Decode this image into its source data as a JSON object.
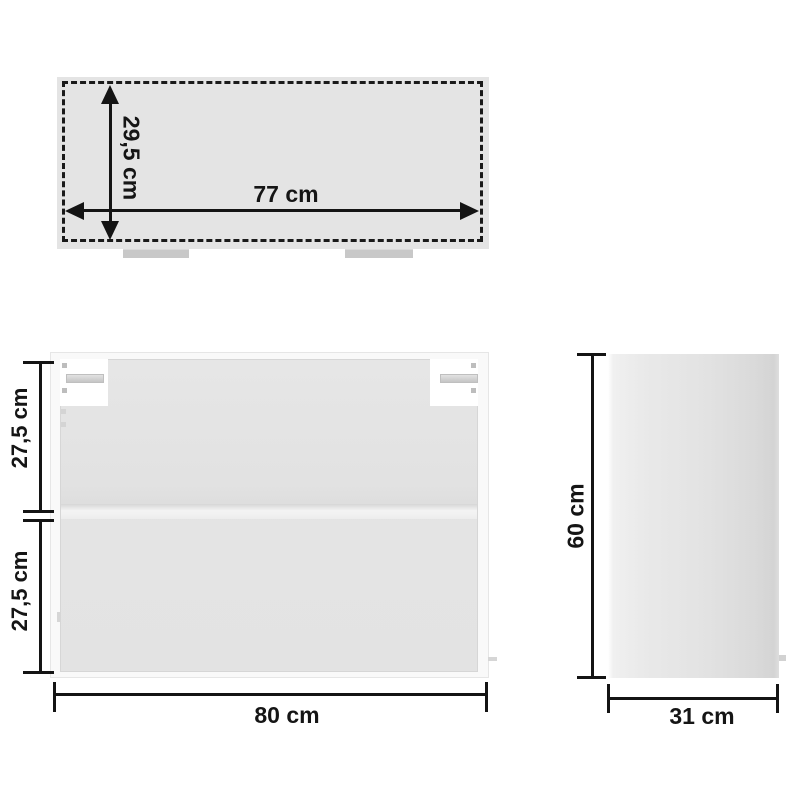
{
  "diagram": {
    "background": "#ffffff",
    "line_color": "#141414",
    "panel_fill": "#e4e4e4",
    "bracket_fill": "#c8c8c8",
    "views": {
      "top": {
        "width_label": "77 cm",
        "depth_label": "29,5 cm"
      },
      "front": {
        "width_label": "80 cm",
        "upper_section_label": "27,5 cm",
        "lower_section_label": "27,5 cm"
      },
      "side": {
        "height_label": "60 cm",
        "depth_label": "31 cm"
      }
    }
  }
}
